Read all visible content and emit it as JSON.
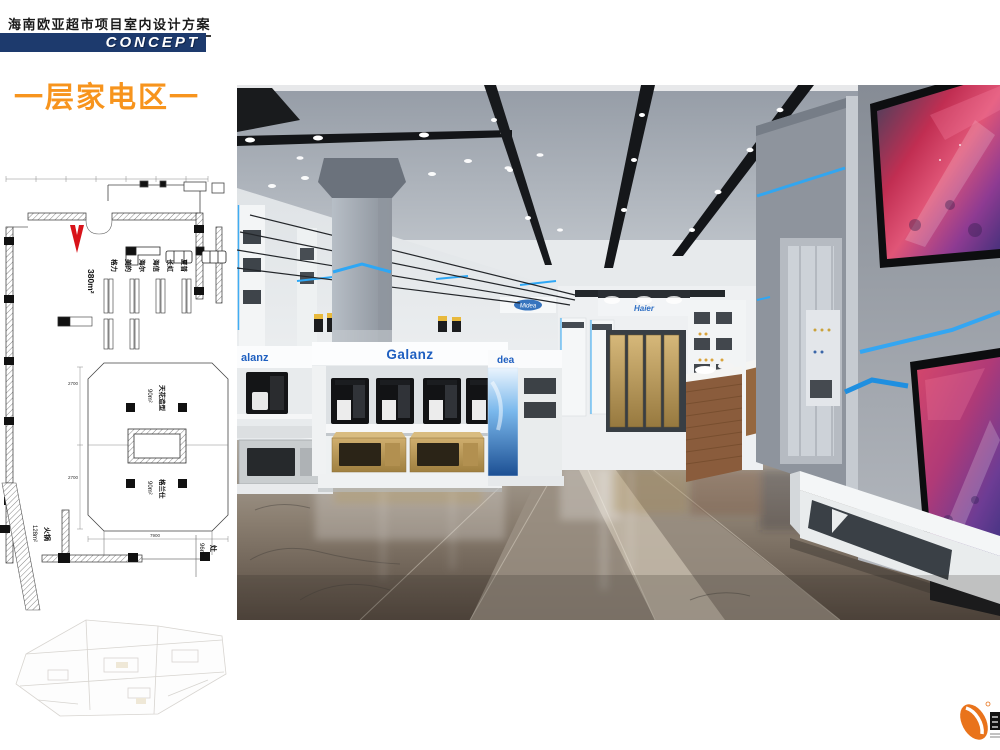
{
  "header": {
    "title": "海南欧亚超市项目室内设计方案",
    "banner": "CONCEPT"
  },
  "section": {
    "title": "一层家电区",
    "suffix_dash": "一"
  },
  "floor_plan": {
    "area_main": "380m²",
    "brand_labels": [
      "格力",
      "美的",
      "海尔",
      "海信",
      "长虹",
      "夏普"
    ],
    "zone_top": {
      "name": "天花造型",
      "area": "90m²"
    },
    "zone_bottom": {
      "name": "格兰仕",
      "area": "90m²"
    },
    "zone_left": {
      "name": "火锅",
      "area": "128m²"
    },
    "zone_right": {
      "name": "灶",
      "area": "96m²"
    },
    "dimensions": {
      "d1": "2700",
      "d2": "2700",
      "d3": "7900"
    }
  },
  "render": {
    "sign_galanz": "Galanz",
    "sign_galanz_partial": "alanz",
    "sign_midea_partial": "dea",
    "logo_midea": "Midea",
    "logo_haier": "Haier"
  },
  "colors": {
    "accent_orange": "#F7941D",
    "banner_navy": "#1d3a6d",
    "led_blue": "#2EA7F5",
    "sign_blue": "#1e5fc0",
    "plan_red": "#D8131A"
  }
}
